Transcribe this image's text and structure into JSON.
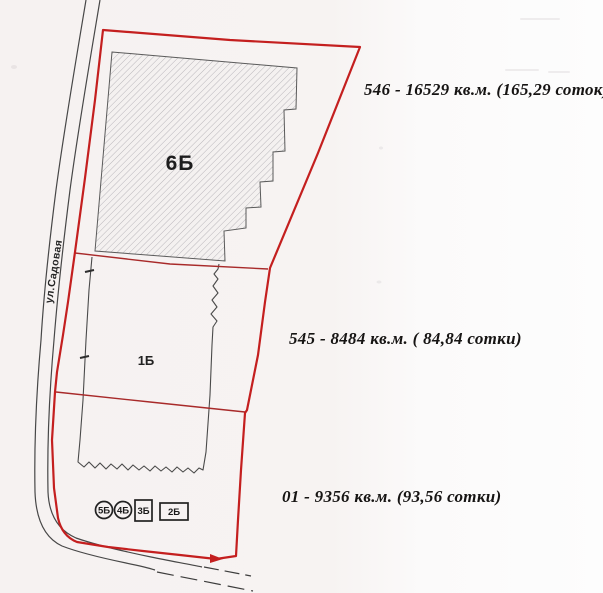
{
  "map": {
    "street_label": "ул.Садовая",
    "plots": {
      "hatched_plot_label": "6Б",
      "middle_plot_label": "1Б"
    },
    "area_labels": {
      "parcel_546": "546 - 16529 кв.м. (165,29 соток)",
      "parcel_545": "545 - 8484 кв.м. ( 84,84 сотки)",
      "parcel_01": "01 - 9356 кв.м. (93,56 сотки)"
    },
    "markers": [
      {
        "label": "5Б",
        "shape": "circle"
      },
      {
        "label": "4Б",
        "shape": "circle"
      },
      {
        "label": "3Б",
        "shape": "box"
      },
      {
        "label": "2Б",
        "shape": "box"
      }
    ],
    "colors": {
      "boundary_red": "#c41f1f",
      "divider_red": "#a82a2a",
      "line_black": "#474747",
      "hatch_gray": "#b3b0b6",
      "paper_background": "#f6f2f1",
      "text_black": "#161413"
    }
  }
}
